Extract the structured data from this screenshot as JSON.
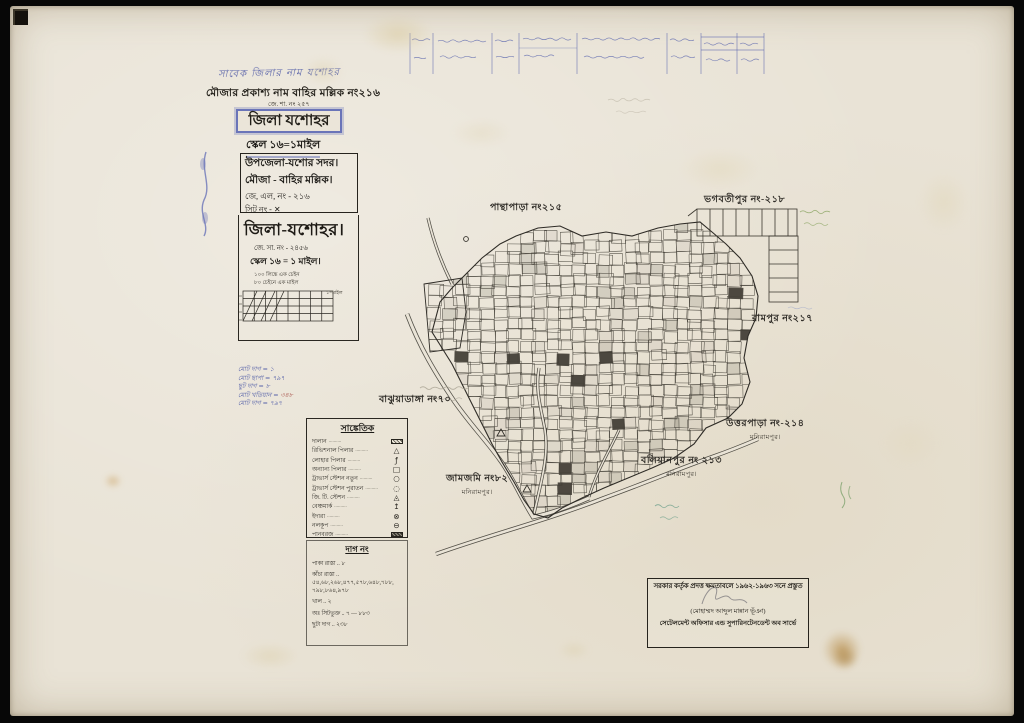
{
  "page": {
    "background": "#070707",
    "paper_color": "#e9e3d6"
  },
  "header": {
    "handwritten_line": "সাবেক জিলার নাম যশোহর",
    "mouza_title": "মৌজার প্রকাশ্য নাম বাহির মল্লিক নং২১৬",
    "small_ref": "জে. শা. নং ২৫৭",
    "district_boxed": "জিলা যশোহর",
    "scale_top": "স্কেল ১৬=১মাইল",
    "info_box": {
      "upazila": "উপজেলা-যশোর সদর।",
      "mouza": "মৌজা - বাহির মল্লিক।",
      "jl_no": "জে, এল, নং - ২১৬",
      "sheet_no": "সিট নং - ✕"
    },
    "district_large": "জিলা-যশোহর।",
    "rs_no": "জে. সা. নং - ২৪৫৬",
    "scale_line": "স্কেল ১৬ = ১ মাইল।",
    "scale_note1": "১০০ লিঙ্কে এক চেইন",
    "scale_note2": "৮০ চেইনে এক মাইল",
    "scale_bar_label": "১=মাইল"
  },
  "notes_left": {
    "lines": [
      "মোট দাগ = ১",
      "মোট ছাপা = ৭৯৭",
      "ছুট দাগ = ৮",
      "মোট খতিয়ান = ৩৪৮",
      "মোট দাগ = ৭৯৭"
    ],
    "accent": "৩৪৮"
  },
  "legend": {
    "title": "সাঙ্কেতিক",
    "leader": "..........",
    "items": [
      {
        "label": "দালান",
        "symbol": "hatch-light",
        "glyph": ""
      },
      {
        "label": "রিভিশনাল পিলার",
        "symbol": "glyph",
        "glyph": "△"
      },
      {
        "label": "লোহার পিলার",
        "symbol": "glyph",
        "glyph": "ƒ"
      },
      {
        "label": "অন্যান্য পিলার",
        "symbol": "glyph",
        "glyph": "□"
      },
      {
        "label": "ট্রাভার্স স্টেশন নতুন",
        "symbol": "glyph",
        "glyph": "○"
      },
      {
        "label": "ট্রাভার্স স্টেশন পুরাতন",
        "symbol": "glyph",
        "glyph": "◌"
      },
      {
        "label": "জি. টি. স্টেশন",
        "symbol": "glyph",
        "glyph": "◬"
      },
      {
        "label": "বেঞ্চমার্ক",
        "symbol": "glyph",
        "glyph": "↥"
      },
      {
        "label": "ইদারা",
        "symbol": "glyph",
        "glyph": "⊗"
      },
      {
        "label": "নলকূপ",
        "symbol": "glyph",
        "glyph": "⊖"
      },
      {
        "label": "পানবরজ",
        "symbol": "hatch-dark",
        "glyph": ""
      }
    ]
  },
  "dag_section": {
    "title": "দাগ নং",
    "rows": [
      {
        "label": "পাকা রাস্তা",
        "value": "৮"
      },
      {
        "label": "কাঁচা রাস্তা",
        "value": "৫৪,৬৮,২৬৮,৪৭৭,৫৭৮,৬৪৮,৭৮৮, ৭৯৮,৮৬৪,৯৭৮"
      },
      {
        "label": "খাল",
        "value": "২"
      },
      {
        "label": "অঃ সিটভুক্ত",
        "value": "৭ — ৮৮৩"
      },
      {
        "label": "ছুটা দাগ",
        "value": "২৩৮"
      }
    ]
  },
  "map_labels": [
    {
      "text": "পান্থাপাড়া নং২১৫",
      "sub": "",
      "x": 490,
      "y": 201
    },
    {
      "text": "ভগবতীপুর নং-২১৮",
      "sub": "",
      "x": 704,
      "y": 193
    },
    {
      "text": "রামপুর নং২১৭",
      "sub": "",
      "x": 752,
      "y": 312
    },
    {
      "text": "উত্তরপাড়া নং-২১৪",
      "sub": "মনিরামপুর।",
      "x": 726,
      "y": 417
    },
    {
      "text": "বলিয়ানপুর নং ২১৩",
      "sub": "মনিরামপুর।",
      "x": 641,
      "y": 454
    },
    {
      "text": "জামজমি নং৮২",
      "sub": "মনিরামপুর।",
      "x": 446,
      "y": 472
    },
    {
      "text": "বাঝুয়াডাঙ্গা নং৭০",
      "sub": "",
      "x": 379,
      "y": 393
    }
  ],
  "attestation": {
    "line1": "সরকার কর্তৃক প্রদত্ত ক্ষমতাবলে ১৯৬২-১৯৬৩ সনে প্রস্তুত",
    "signatory": "(মোহাম্মদ আব্দুল মান্নান ভূঁঞা)",
    "line2": "সেটেলমেন্ট অফিসার এন্ড সুপারিনটেনডেন্ট অব সার্ভে"
  }
}
